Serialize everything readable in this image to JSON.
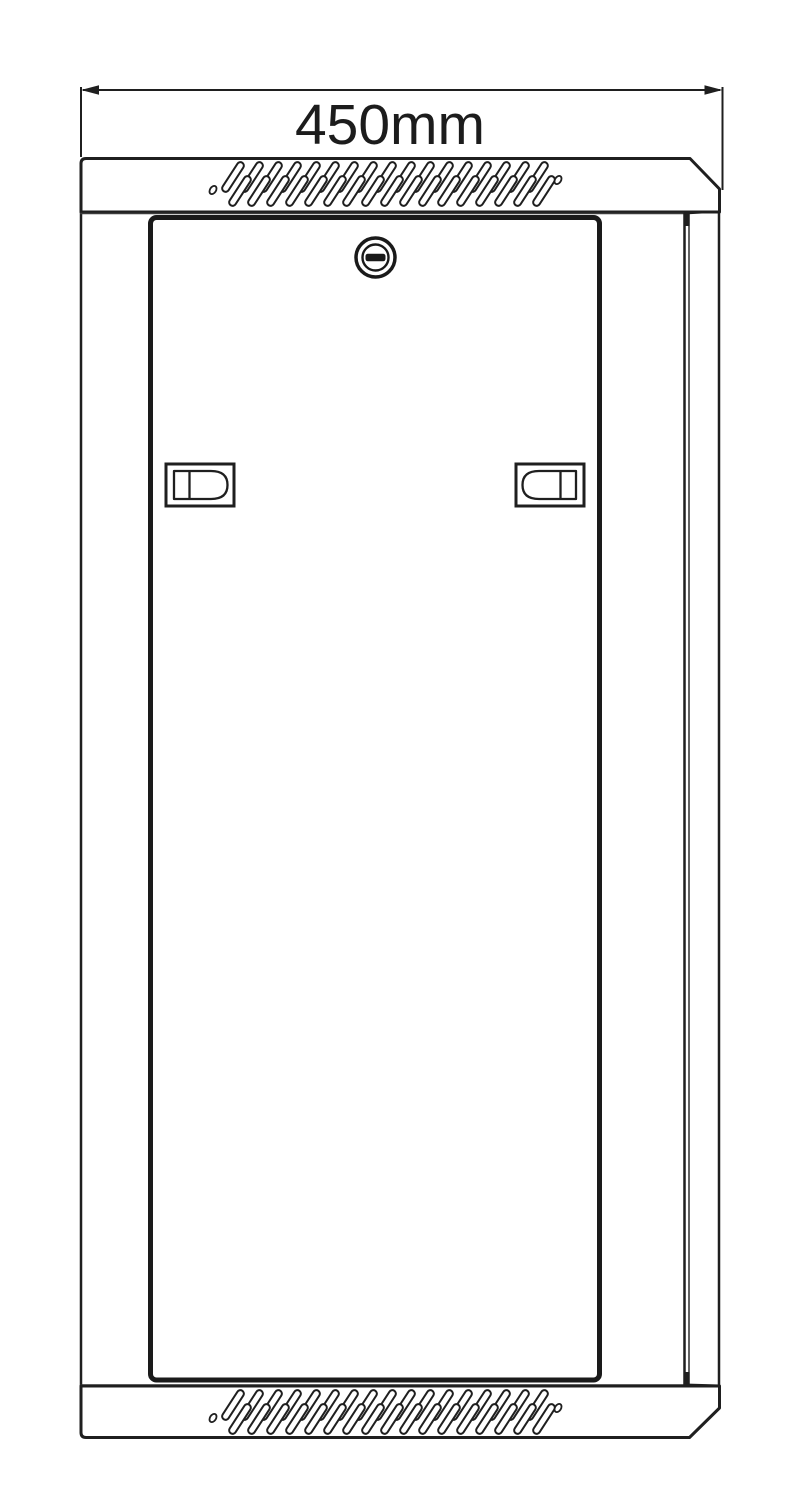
{
  "page": {
    "background": "#ffffff"
  },
  "dimension": {
    "width_label": "450mm"
  },
  "drawing": {
    "line_color": "#1f1f1f",
    "thin_line_color": "#3c3c3c",
    "fill_color": "#ffffff"
  },
  "vents": {
    "rows": 2,
    "slats_per_row": 17,
    "slat_length": 34,
    "slat_width": 7,
    "angle_deg": -57,
    "spacing": 19,
    "start_x": 233,
    "row_offset_x": 7,
    "row_offset_y": 14,
    "stroke_width": 2,
    "top_band_y": 177,
    "bottom_band_y": 1405,
    "hole_rx": 4.5,
    "hole_ry": 3,
    "holes_top": [
      [
        213,
        190
      ],
      [
        558,
        180
      ]
    ],
    "holes_bottom": [
      [
        213,
        1418
      ],
      [
        558,
        1408
      ]
    ]
  },
  "parts": {
    "top_panel": "vented-top-panel",
    "bottom_panel": "vented-bottom-panel",
    "door": "front-door",
    "lock": "cam-lock",
    "latch_left": "left-latch",
    "latch_right": "right-latch",
    "side": "right-side-edge"
  }
}
